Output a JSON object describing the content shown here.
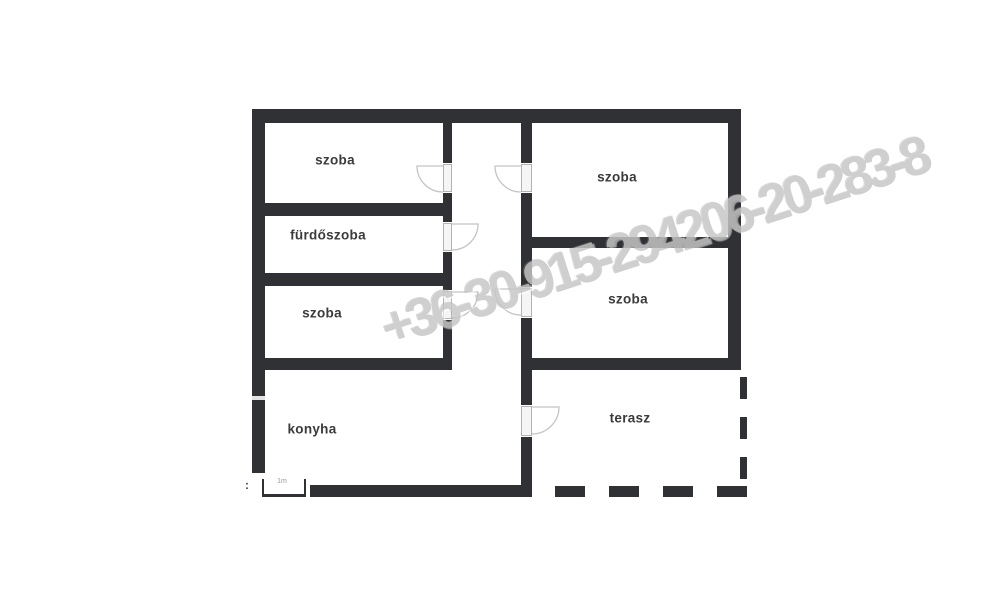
{
  "floorplan": {
    "rooms": [
      {
        "id": "szoba-top-left",
        "label": "szoba"
      },
      {
        "id": "furdoszoba",
        "label": "fürdőszoba"
      },
      {
        "id": "szoba-bottom-left",
        "label": "szoba"
      },
      {
        "id": "konyha",
        "label": "konyha"
      },
      {
        "id": "szoba-top-right",
        "label": "szoba"
      },
      {
        "id": "szoba-mid-right",
        "label": "szoba"
      },
      {
        "id": "terasz",
        "label": "terasz"
      }
    ],
    "door_count": 6
  },
  "watermark": {
    "text": "+36-30-915-294206-20-283-8"
  },
  "scale": {
    "colon": ":",
    "label": "1m"
  },
  "colors": {
    "wall": "#303134",
    "door_arc": "#c4c4c4",
    "watermark": "#c7c7c7",
    "label_text": "#3b3b3b",
    "background": "#ffffff"
  }
}
